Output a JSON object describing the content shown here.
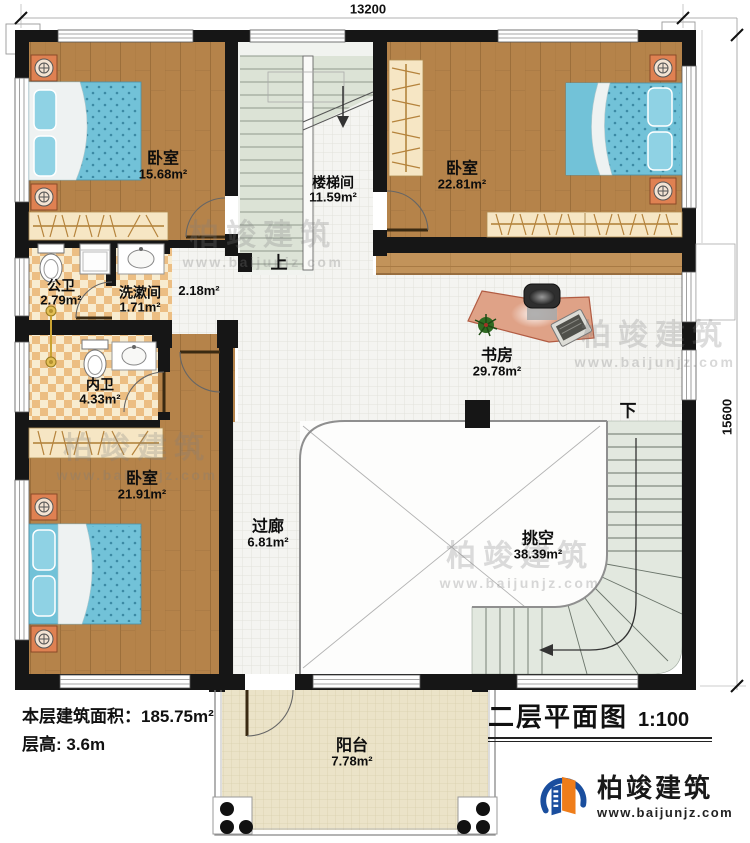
{
  "plan": {
    "dimensions": {
      "top": "13200",
      "right": "15600"
    },
    "rooms": [
      {
        "id": "bedroom-top-left",
        "name": "卧室",
        "area": "15.68m²"
      },
      {
        "id": "stairwell",
        "name": "楼梯间",
        "area": "11.59m²"
      },
      {
        "id": "bedroom-top-right",
        "name": "卧室",
        "area": "22.81m²"
      },
      {
        "id": "public-bath",
        "name": "公卫",
        "area": "2.79m²"
      },
      {
        "id": "wash-room",
        "name": "洗漱间",
        "area": "1.71m²"
      },
      {
        "id": "hall",
        "name": "",
        "area": "2.18m²"
      },
      {
        "id": "private-bath",
        "name": "内卫",
        "area": "4.33m²"
      },
      {
        "id": "study",
        "name": "书房",
        "area": "29.78m²"
      },
      {
        "id": "bedroom-bottom",
        "name": "卧室",
        "area": "21.91m²"
      },
      {
        "id": "corridor",
        "name": "过廊",
        "area": "6.81m²"
      },
      {
        "id": "void",
        "name": "挑空",
        "area": "38.39m²"
      },
      {
        "id": "balcony",
        "name": "阳台",
        "area": "7.78m²"
      }
    ],
    "stair_up": "上",
    "stair_down": "下"
  },
  "info": {
    "floor_area": "本层建筑面积：185.75m²",
    "floor_height": "层高: 3.6m"
  },
  "titleblock": {
    "title": "二层平面图",
    "scale": "1:100"
  },
  "brand": {
    "name": "柏竣建筑",
    "website": "www.baijunjz.com"
  }
}
